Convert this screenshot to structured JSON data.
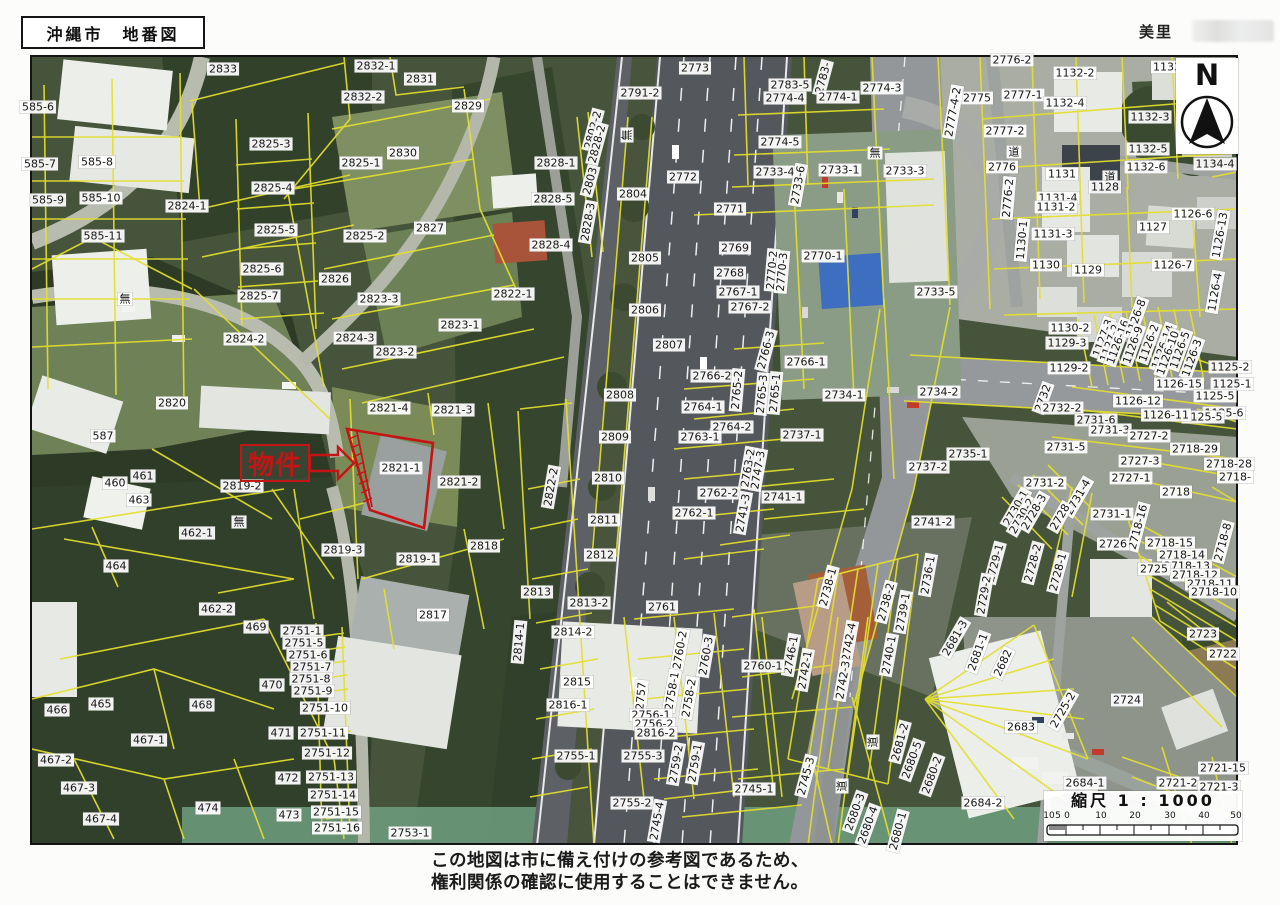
{
  "header": {
    "title": "沖縄市　地番図",
    "area_label": "美里"
  },
  "north": {
    "label": "N"
  },
  "property": {
    "label": "物件",
    "parcel_id": "2821-1"
  },
  "scalebar": {
    "title": "縮尺 1 : 1000",
    "left_ticks": [
      "10",
      "5",
      "0"
    ],
    "main_ticks": [
      "10",
      "20",
      "30",
      "40",
      "50"
    ]
  },
  "footer": {
    "line1": "この地図は市に備え付けの参考図であるため、",
    "line2": "権利関係の確認に使用することはできません。"
  },
  "colors": {
    "parcel_line": "#e4df2e",
    "highlight_red": "#c51414",
    "label_bg": "#ffffff",
    "frame": "#141414"
  },
  "map": {
    "labels": [
      [
        "585-6",
        38,
        107
      ],
      [
        "2833",
        223,
        69
      ],
      [
        "2825-3",
        271,
        144
      ],
      [
        "585-7",
        40,
        164
      ],
      [
        "585-8",
        97,
        162
      ],
      [
        "2825-4",
        273,
        188
      ],
      [
        "585-9",
        48,
        200
      ],
      [
        "585-10",
        101,
        198
      ],
      [
        "2824-1",
        187,
        206
      ],
      [
        "2825-5",
        276,
        230
      ],
      [
        "585-11",
        103,
        236
      ],
      [
        "2825-6",
        262,
        269
      ],
      [
        "2825-7",
        259,
        296
      ],
      [
        "無",
        125,
        299
      ],
      [
        "2824-2",
        245,
        339
      ],
      [
        "2820",
        172,
        403
      ],
      [
        "587",
        103,
        436
      ],
      [
        "461",
        143,
        476
      ],
      [
        "460",
        115,
        483
      ],
      [
        "463",
        139,
        500
      ],
      [
        "2819-2",
        242,
        486
      ],
      [
        "無",
        239,
        522
      ],
      [
        "462-1",
        197,
        533
      ],
      [
        "464",
        116,
        566
      ],
      [
        "462-2",
        217,
        609
      ],
      [
        "469",
        256,
        627
      ],
      [
        "470",
        272,
        685
      ],
      [
        "465",
        101,
        704
      ],
      [
        "466",
        57,
        710
      ],
      [
        "468",
        202,
        705
      ],
      [
        "471",
        281,
        733
      ],
      [
        "467-1",
        149,
        740
      ],
      [
        "467-2",
        56,
        760
      ],
      [
        "467-3",
        79,
        788
      ],
      [
        "472",
        288,
        778
      ],
      [
        "474",
        208,
        808
      ],
      [
        "473",
        289,
        815
      ],
      [
        "467-4",
        101,
        819
      ],
      [
        "2832-1",
        376,
        66
      ],
      [
        "2831",
        420,
        79
      ],
      [
        "2832-2",
        363,
        97
      ],
      [
        "2829",
        468,
        106
      ],
      [
        "2830",
        403,
        153
      ],
      [
        "2825-1",
        361,
        163
      ],
      [
        "2828-1",
        556,
        163
      ],
      [
        "2802-2",
        593,
        130,
        -75
      ],
      [
        "2828-2",
        597,
        144,
        -75
      ],
      [
        "無",
        627,
        135,
        -90
      ],
      [
        "2803",
        590,
        181,
        -75
      ],
      [
        "2828-3",
        588,
        222,
        -80
      ],
      [
        "2828-5",
        553,
        199
      ],
      [
        "2825-2",
        365,
        236
      ],
      [
        "2827",
        430,
        228
      ],
      [
        "2828-4",
        551,
        245
      ],
      [
        "2826",
        335,
        279
      ],
      [
        "2823-3",
        379,
        299
      ],
      [
        "2822-1",
        513,
        294
      ],
      [
        "2823-1",
        460,
        325
      ],
      [
        "2824-3",
        355,
        338
      ],
      [
        "2823-2",
        395,
        352
      ],
      [
        "2773",
        695,
        68
      ],
      [
        "2791-2",
        640,
        93
      ],
      [
        "2772",
        683,
        177
      ],
      [
        "2804",
        633,
        194
      ],
      [
        "2805",
        645,
        258
      ],
      [
        "2806",
        645,
        310
      ],
      [
        "2807",
        669,
        345
      ],
      [
        "2808",
        620,
        395
      ],
      [
        "2809",
        615,
        437
      ],
      [
        "2810",
        608,
        478
      ],
      [
        "2811",
        604,
        520
      ],
      [
        "2812",
        600,
        555
      ],
      [
        "2822-2",
        551,
        487,
        -80
      ],
      [
        "2813",
        537,
        592
      ],
      [
        "2813-2",
        589,
        603
      ],
      [
        "2814-2",
        573,
        632
      ],
      [
        "2814-1",
        519,
        642,
        -85
      ],
      [
        "2818",
        484,
        546
      ],
      [
        "2815",
        577,
        682
      ],
      [
        "2816-1",
        568,
        705
      ],
      [
        "2755-1",
        576,
        756
      ],
      [
        "2761",
        662,
        607
      ],
      [
        "2821-4",
        389,
        408
      ],
      [
        "2821-3",
        453,
        410
      ],
      [
        "2821-1",
        401,
        468
      ],
      [
        "2821-2",
        459,
        482
      ],
      [
        "2819-3",
        343,
        550
      ],
      [
        "2819-1",
        418,
        559
      ],
      [
        "2817",
        433,
        615
      ],
      [
        "2751-1",
        302,
        631
      ],
      [
        "2751-5",
        304,
        643
      ],
      [
        "2751-6",
        308,
        655
      ],
      [
        "2751-7",
        312,
        667
      ],
      [
        "2751-8",
        311,
        679
      ],
      [
        "2751-9",
        313,
        691
      ],
      [
        "2751-10",
        325,
        708
      ],
      [
        "2751-11",
        323,
        733
      ],
      [
        "2751-12",
        327,
        753
      ],
      [
        "2751-13",
        331,
        777
      ],
      [
        "2751-14",
        333,
        795
      ],
      [
        "2751-15",
        336,
        812
      ],
      [
        "2751-16",
        337,
        828
      ],
      [
        "2753-1",
        410,
        833
      ],
      [
        "2783-5",
        790,
        85
      ],
      [
        "2774-4",
        785,
        98
      ],
      [
        "2783-",
        823,
        78,
        -75
      ],
      [
        "2774-1",
        838,
        97
      ],
      [
        "2774-3",
        882,
        88
      ],
      [
        "無",
        875,
        153
      ],
      [
        "2774-5",
        780,
        142
      ],
      [
        "2733-4",
        775,
        172
      ],
      [
        "2733-1",
        840,
        170
      ],
      [
        "2733-3",
        905,
        171
      ],
      [
        "2733-6",
        798,
        185,
        -80
      ],
      [
        "2770-1",
        823,
        256
      ],
      [
        "2769",
        735,
        248
      ],
      [
        "2768",
        730,
        273
      ],
      [
        "2767-1",
        738,
        292
      ],
      [
        "2770-2",
        772,
        270,
        -85
      ],
      [
        "2770-3",
        782,
        272,
        -85
      ],
      [
        "2767-2",
        750,
        307
      ],
      [
        "2771",
        730,
        209
      ],
      [
        "2766-3",
        766,
        350,
        -75
      ],
      [
        "2766-1",
        806,
        362
      ],
      [
        "2766-2",
        712,
        376
      ],
      [
        "2765-2",
        737,
        390,
        -85
      ],
      [
        "2765-3",
        762,
        394,
        -85
      ],
      [
        "2765-1",
        775,
        393,
        -85
      ],
      [
        "2734-1",
        844,
        395
      ],
      [
        "2764-1",
        703,
        407
      ],
      [
        "2764-2",
        732,
        427
      ],
      [
        "2763-1",
        700,
        437
      ],
      [
        "2737-1",
        802,
        435
      ],
      [
        "2763-2",
        748,
        468,
        -80
      ],
      [
        "2747-3",
        758,
        470,
        -80
      ],
      [
        "2762-2",
        719,
        493
      ],
      [
        "2762-1",
        694,
        513
      ],
      [
        "2741-1",
        783,
        497
      ],
      [
        "2741-3",
        743,
        513,
        -80
      ],
      [
        "2741-2",
        933,
        522
      ],
      [
        "2733-5",
        936,
        292
      ],
      [
        "2734-2",
        939,
        392
      ],
      [
        "2735-1",
        968,
        454
      ],
      [
        "2737-2",
        928,
        467
      ],
      [
        "2776-2",
        1012,
        60
      ],
      [
        "1132-2",
        1075,
        73
      ],
      [
        "1133",
        1167,
        67
      ],
      [
        "2775",
        977,
        98
      ],
      [
        "2777-1",
        1023,
        95
      ],
      [
        "2777-4-2",
        953,
        112,
        -80
      ],
      [
        "1132-4",
        1065,
        103
      ],
      [
        "1132-3",
        1150,
        117
      ],
      [
        "2777-2",
        1005,
        131
      ],
      [
        "1132-5",
        1148,
        149
      ],
      [
        "1134-4",
        1215,
        164
      ],
      [
        "道",
        1014,
        152
      ],
      [
        "2776",
        1002,
        167
      ],
      [
        "1132-6",
        1146,
        167
      ],
      [
        "1131",
        1062,
        174
      ],
      [
        "道",
        1110,
        177
      ],
      [
        "1128",
        1105,
        187
      ],
      [
        "2776-2",
        1008,
        198,
        -85
      ],
      [
        "1131-4",
        1058,
        198
      ],
      [
        "1131-2",
        1056,
        207
      ],
      [
        "1131-3",
        1053,
        234
      ],
      [
        "1130-1",
        1022,
        240,
        -85
      ],
      [
        "1127",
        1153,
        227
      ],
      [
        "1126-6",
        1193,
        214
      ],
      [
        "1126-13",
        1220,
        235,
        -80
      ],
      [
        "1130",
        1046,
        265
      ],
      [
        "1129",
        1088,
        270
      ],
      [
        "1126-7",
        1173,
        265
      ],
      [
        "1126-4",
        1215,
        292,
        -80
      ],
      [
        "1130-2",
        1070,
        328
      ],
      [
        "1129-3",
        1067,
        343
      ],
      [
        "1127-3",
        1103,
        338,
        -70
      ],
      [
        "1127-2",
        1110,
        343,
        -70
      ],
      [
        "1126-16",
        1118,
        342,
        -70
      ],
      [
        "1126-8",
        1136,
        318,
        -70
      ],
      [
        "1126-9",
        1133,
        345,
        -70
      ],
      [
        "1126-2",
        1149,
        343,
        -70
      ],
      [
        "1126-14",
        1163,
        347,
        -70
      ],
      [
        "1126-10",
        1168,
        353,
        -70
      ],
      [
        "1126-5",
        1180,
        350,
        -70
      ],
      [
        "1126-3",
        1192,
        358,
        -70
      ],
      [
        "1129-2",
        1069,
        368
      ],
      [
        "1125-2",
        1230,
        367
      ],
      [
        "1126-15",
        1179,
        384
      ],
      [
        "1125-1",
        1232,
        384
      ],
      [
        "1125-5",
        1215,
        396
      ],
      [
        "1125-6",
        1224,
        413
      ],
      [
        "1125-5",
        1203,
        417
      ],
      [
        "1126-12",
        1138,
        401
      ],
      [
        "1126-11",
        1166,
        415
      ],
      [
        "2732",
        1043,
        398,
        -70
      ],
      [
        "2732-2",
        1062,
        408
      ],
      [
        "2731-6",
        1096,
        420
      ],
      [
        "2731-3",
        1110,
        430
      ],
      [
        "2727-2",
        1149,
        436
      ],
      [
        "2718-29",
        1195,
        449
      ],
      [
        "2731-5",
        1066,
        447
      ],
      [
        "2727-3",
        1140,
        461
      ],
      [
        "2718-28",
        1229,
        464
      ],
      [
        "2718-",
        1235,
        477
      ],
      [
        "2731-2",
        1045,
        483
      ],
      [
        "2727-1",
        1131,
        478
      ],
      [
        "2718",
        1176,
        492
      ],
      [
        "2731-4",
        1078,
        497,
        -60
      ],
      [
        "2731-1",
        1112,
        514
      ],
      [
        "2730-1",
        1016,
        508,
        -60
      ],
      [
        "2730-2",
        1022,
        516,
        -60
      ],
      [
        "2728-3",
        1034,
        512,
        -60
      ],
      [
        "2728",
        1060,
        517,
        -60
      ],
      [
        "2718-16",
        1138,
        527,
        -75
      ],
      [
        "2726",
        1113,
        544
      ],
      [
        "2718-15",
        1170,
        543
      ],
      [
        "2718-14",
        1182,
        555
      ],
      [
        "2718-13",
        1187,
        566
      ],
      [
        "2718-12",
        1195,
        575
      ],
      [
        "2718-11",
        1210,
        584
      ],
      [
        "2718-10",
        1214,
        592
      ],
      [
        "2718-8",
        1223,
        542,
        -75
      ],
      [
        "2725",
        1154,
        569
      ],
      [
        "2723",
        1203,
        634
      ],
      [
        "2722",
        1223,
        654
      ],
      [
        "2724",
        1127,
        700
      ],
      [
        "2738-1",
        828,
        587,
        -75
      ],
      [
        "2738-2",
        886,
        602,
        -75
      ],
      [
        "2736-1",
        928,
        575,
        -80
      ],
      [
        "2729-1",
        995,
        563,
        -75
      ],
      [
        "2729-2",
        984,
        595,
        -80
      ],
      [
        "2728-2",
        1033,
        563,
        -75
      ],
      [
        "2728-1",
        1058,
        572,
        -75
      ],
      [
        "2739-1",
        903,
        612,
        -80
      ],
      [
        "2742-4",
        849,
        642,
        -80
      ],
      [
        "2746-1",
        791,
        655,
        -80
      ],
      [
        "2742-1",
        805,
        670,
        -80
      ],
      [
        "2742-3",
        843,
        680,
        -80
      ],
      [
        "2740-1",
        889,
        655,
        -80
      ],
      [
        "2681-3",
        955,
        638,
        -60
      ],
      [
        "2681-1",
        978,
        652,
        -70
      ],
      [
        "2682",
        1003,
        663,
        -65
      ],
      [
        "2725-2",
        1063,
        710,
        -60
      ],
      [
        "2683",
        1021,
        727
      ],
      [
        "2681-2",
        900,
        742,
        -75
      ],
      [
        "2680-5",
        912,
        760,
        -70
      ],
      [
        "2680-2",
        932,
        775,
        -70
      ],
      [
        "道",
        873,
        742,
        -90
      ],
      [
        "道",
        842,
        786,
        -90
      ],
      [
        "2684-2",
        983,
        803
      ],
      [
        "2680-3",
        855,
        812,
        -70
      ],
      [
        "2680-4",
        868,
        825,
        -70
      ],
      [
        "2680-1",
        898,
        831,
        -75
      ],
      [
        "2684-1",
        1085,
        783
      ],
      [
        "2721-15",
        1223,
        768
      ],
      [
        "2721-2",
        1178,
        783
      ],
      [
        "2721-3",
        1219,
        787
      ],
      [
        "2760-2",
        680,
        650,
        -80
      ],
      [
        "2760-3",
        706,
        656,
        -80
      ],
      [
        "2760-1",
        763,
        666
      ],
      [
        "2757",
        641,
        696,
        -85
      ],
      [
        "2758-1",
        672,
        691,
        -80
      ],
      [
        "2758-2",
        689,
        698,
        -80
      ],
      [
        "2756-1",
        651,
        715
      ],
      [
        "2756-2",
        654,
        724
      ],
      [
        "2816-2",
        656,
        733
      ],
      [
        "2755-3",
        643,
        756
      ],
      [
        "2759-2",
        676,
        764,
        -80
      ],
      [
        "2759-1",
        695,
        763,
        -80
      ],
      [
        "2745-1",
        754,
        789
      ],
      [
        "2745-3",
        806,
        776,
        -75
      ],
      [
        "2755-2",
        632,
        803
      ],
      [
        "2745-4",
        657,
        821,
        -80
      ]
    ]
  }
}
